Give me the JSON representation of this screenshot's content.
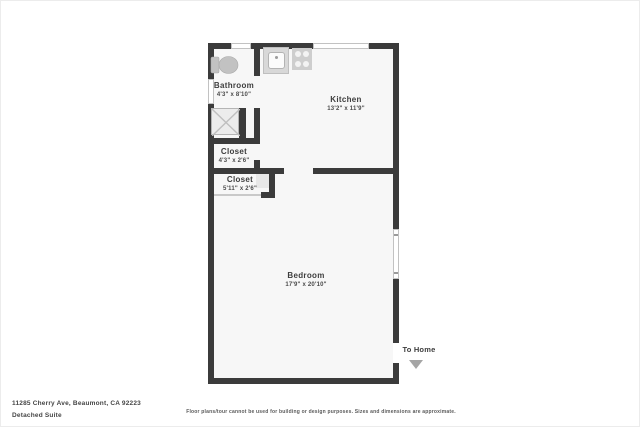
{
  "floorplan": {
    "rooms": [
      {
        "name": "Bathroom",
        "dims": "4'3\" x 8'10\""
      },
      {
        "name": "Kitchen",
        "dims": "13'2\" x 11'9\""
      },
      {
        "name": "Closet",
        "dims": "4'3\" x 2'6\""
      },
      {
        "name": "Closet",
        "dims": "5'11\" x 2'6\""
      },
      {
        "name": "Bedroom",
        "dims": "17'9\" x 20'10\""
      }
    ],
    "exit": {
      "label": "To Home"
    },
    "icons": [
      "toilet-icon",
      "shower-icon",
      "sink-icon",
      "stove-icon",
      "window",
      "to-home-arrow-icon"
    ]
  },
  "footer": {
    "address": "11285 Cherry Ave, Beaumont, CA 92223",
    "unit": "Detached Suite",
    "disclaimer": "Floor plans/tour cannot be used for building or design purposes. Sizes and dimensions are approximate."
  },
  "colors": {
    "wall": "#3b3b3b",
    "room_fill": "#f7f7f7",
    "fixture": "#c9c9c9",
    "text": "#3d3d3d",
    "arrow": "#a5a5a5"
  }
}
